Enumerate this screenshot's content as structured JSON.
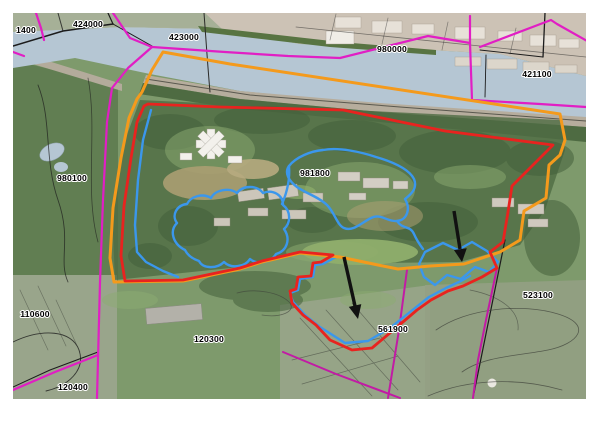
{
  "map": {
    "labels": [
      {
        "id": "label-1400",
        "text": "1400"
      },
      {
        "id": "label-424000",
        "text": "424000"
      },
      {
        "id": "label-423000",
        "text": "423000"
      },
      {
        "id": "label-980000",
        "text": "980000"
      },
      {
        "id": "label-421100",
        "text": "421100"
      },
      {
        "id": "label-980100",
        "text": "980100"
      },
      {
        "id": "label-981800",
        "text": "981800"
      },
      {
        "id": "label-110600",
        "text": "110600"
      },
      {
        "id": "label-120300",
        "text": "120300"
      },
      {
        "id": "label-120400",
        "text": "120400"
      },
      {
        "id": "label-561900",
        "text": "561900"
      },
      {
        "id": "label-523100",
        "text": "523100"
      }
    ]
  },
  "colors": {
    "water": "#b5c6d3",
    "site_boundary_orange": "#f49a1c",
    "boundary_red": "#e8231f",
    "boundary_blue": "#3b97ec",
    "boundary_magenta": "#e11ec4",
    "boundary_dark_magenta": "#c21ba5",
    "annotation_arrow": "#111111"
  }
}
